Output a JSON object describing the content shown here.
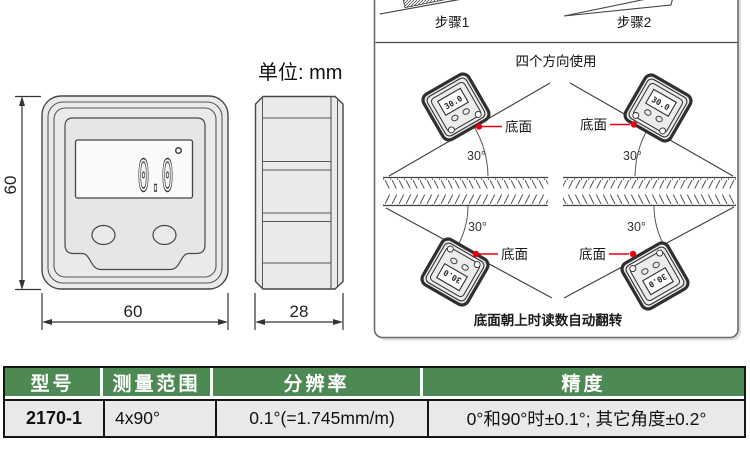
{
  "unit_label": "单位: mm",
  "drawing": {
    "display_value": "0.0",
    "dim_height": "60",
    "dim_width": "60",
    "dim_depth": "28"
  },
  "diagram": {
    "step1_label": "步骤1",
    "step2_label": "步骤2",
    "title": "四个方向使用",
    "angle": "30°",
    "bottom_face": "底面",
    "caption": "底面朝上时读数自动翻转",
    "mini_display": "30.0",
    "accent_red": "#e60012"
  },
  "table": {
    "header_bg": "#4d8a53",
    "headers": [
      "型号",
      "测量范围",
      "分辨率",
      "精度"
    ],
    "row": {
      "model": "2170-1",
      "range": "4x90°",
      "resolution": "0.1°(=1.745mm/m)",
      "accuracy": "0°和90°时±0.1°; 其它角度±0.2°"
    }
  }
}
